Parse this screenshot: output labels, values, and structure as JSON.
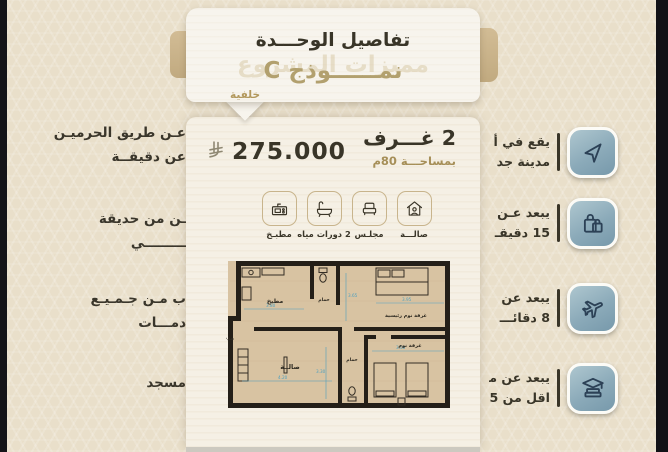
{
  "header": {
    "title": "تفاصيل الوحـــدة",
    "model": "نمــــــوذج C",
    "ghost_text": "مميزات المشروع",
    "tab_label": "خلفية"
  },
  "unit": {
    "rooms": "2 غـــرف",
    "area": "بمساحـــة 80م",
    "price": "275.000",
    "currency": "ريال سعودي"
  },
  "amenities": [
    {
      "icon": "hall-icon",
      "label": "صالـــة"
    },
    {
      "icon": "majlis-icon",
      "label": "مجلـس"
    },
    {
      "icon": "bathrooms-icon",
      "label": "2 دورات مياه"
    },
    {
      "icon": "kitchen-icon",
      "label": "مطبـخ"
    }
  ],
  "background": {
    "left_texts": [
      {
        "lines": [
          "عـن طريق الحرميـن",
          "عن دقيقــة"
        ]
      },
      {
        "lines": [
          "ـن من حديقة",
          "ـــــــــي"
        ]
      },
      {
        "lines": [
          "ب مـن جـمـيـع",
          "دمـــات"
        ]
      },
      {
        "lines": [
          "مسجد"
        ]
      }
    ],
    "right_features": [
      {
        "icon": "navigation-arrow-icon",
        "lines": [
          "يقع في أ",
          "مدينة جد"
        ]
      },
      {
        "icon": "shopping-bags-icon",
        "lines": [
          "يبعد عـن",
          "15 دقيقـ"
        ]
      },
      {
        "icon": "airplane-icon",
        "lines": [
          "يبعد عن",
          "8 دقائـــ"
        ]
      },
      {
        "icon": "graduation-books-icon",
        "lines": [
          "يبعد عن مـ",
          "اقل من 5"
        ]
      }
    ]
  },
  "floorplan": {
    "labels": {
      "kitchen": "مطبخ",
      "bath1": "حمام",
      "master": "غرفة نوم رئيسية",
      "entrance": "مدخـــل",
      "hall": "صالــة",
      "bath2": "حمام",
      "bedroom": "غرفة نوم"
    },
    "dims": [
      "3.80",
      "3.65",
      "4.20",
      "3.30",
      "3.00",
      "3.95"
    ]
  },
  "colors": {
    "page_bg": "#e9dfca",
    "card_bg": "#f5f0e5",
    "dark_text": "#393528",
    "gold_text": "#b2a06e",
    "icon_blue": "#8baab9",
    "floorplan_tan": "#d8c3a2",
    "wall_dark": "#241f18",
    "dimension_blue": "#4fa0bf"
  }
}
